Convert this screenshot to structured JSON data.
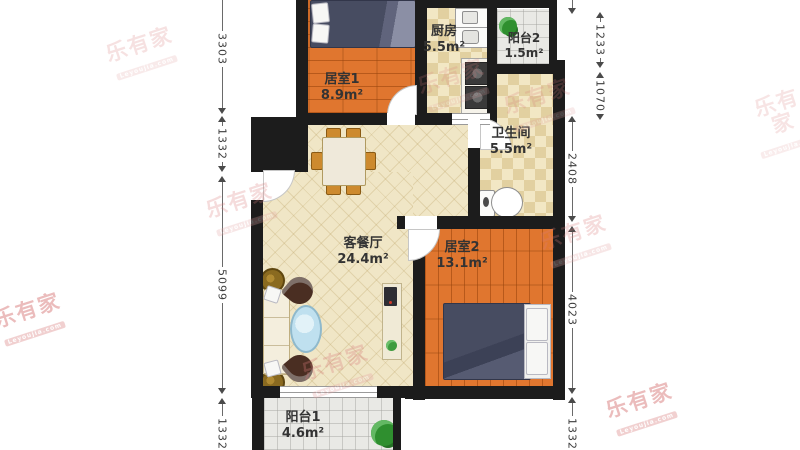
{
  "watermark": {
    "brand": "乐有家",
    "domain": "Leyoujia.com",
    "color": "#d97c7c"
  },
  "rooms": [
    {
      "name": "居室1",
      "area": "8.9m²"
    },
    {
      "name": "厨房",
      "area": "5.5m²"
    },
    {
      "name": "阳台2",
      "area": "1.5m²"
    },
    {
      "name": "卫生间",
      "area": "5.5m²"
    },
    {
      "name": "客餐厅",
      "area": "24.4m²"
    },
    {
      "name": "居室2",
      "area": "13.1m²"
    },
    {
      "name": "阳台1",
      "area": "4.6m²"
    }
  ],
  "dimensions": {
    "left": [
      "3303",
      "1332",
      "5099",
      "1332"
    ],
    "right": [
      "9",
      "1233",
      "1070",
      "2408",
      "4023",
      "1332"
    ]
  },
  "colors": {
    "wall": "#1c1c1c",
    "wood_floor": "#e0762f",
    "living_tile": "#f0e6c6",
    "wet_tile": "#f2e7c4",
    "balcony_tile": "#e9e9e5",
    "bed": "#474c61",
    "dimension_text": "#3c3c3c",
    "watermark_pink": "#d97c7c"
  }
}
